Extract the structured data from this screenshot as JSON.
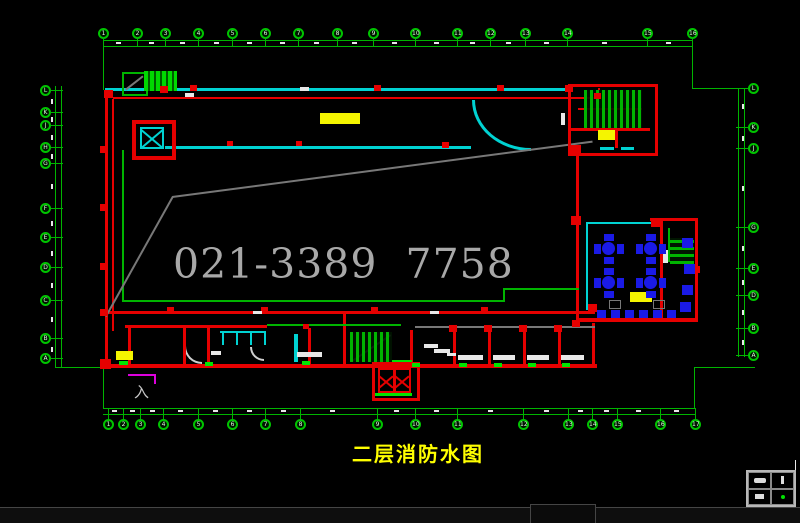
{
  "title_label": {
    "text": "二层消防水图"
  },
  "watermark": {
    "text": "021-3389 7758"
  },
  "entrance_mark": {
    "text": "入"
  },
  "palette": {
    "green": "#00b400",
    "bgreen": "#00e400",
    "cyan": "#00d2d2",
    "red": "#e60000",
    "yellow": "#f5f500",
    "blue": "#1a1ae6",
    "magenta": "#dd00dd",
    "gray": "#787878",
    "white": "#e8e8e8"
  },
  "grid_bubbles": {
    "top": {
      "cy": 33,
      "x": [
        103,
        137,
        165,
        198,
        232,
        265,
        298,
        337,
        373,
        415,
        457,
        490,
        525,
        567,
        647,
        692
      ],
      "labels": [
        "1",
        "2",
        "3",
        "4",
        "5",
        "6",
        "7",
        "8",
        "9",
        "10",
        "11",
        "12",
        "13",
        "14",
        "15",
        "16"
      ]
    },
    "bottom": {
      "cy": 424,
      "x": [
        108,
        123,
        140,
        163,
        198,
        232,
        265,
        300,
        377,
        415,
        457,
        523,
        568,
        592,
        617,
        660,
        695
      ],
      "labels": [
        "1",
        "2",
        "3",
        "4",
        "5",
        "6",
        "7",
        "8",
        "9",
        "10",
        "11",
        "12",
        "13",
        "14",
        "15",
        "16",
        "17"
      ]
    },
    "left": {
      "cx": 45,
      "y": [
        90,
        112,
        125,
        147,
        163,
        208,
        237,
        267,
        300,
        338,
        358
      ],
      "labels": [
        "L",
        "K",
        "J",
        "H",
        "G",
        "F",
        "E",
        "D",
        "C",
        "B",
        "A"
      ]
    },
    "right": {
      "cx": 753,
      "y": [
        88,
        127,
        148,
        227,
        268,
        295,
        328,
        355
      ],
      "labels": [
        "L",
        "K",
        "J",
        "G",
        "E",
        "D",
        "B",
        "A"
      ]
    }
  },
  "drawing": {
    "lines": [
      {
        "n": "dim-top-1",
        "x": 103,
        "y": 40,
        "w": 590,
        "h": 1,
        "c": "green"
      },
      {
        "n": "dim-top-2",
        "x": 103,
        "y": 46,
        "w": 590,
        "h": 1,
        "c": "green"
      },
      {
        "n": "dim-left-1",
        "x": 55,
        "y": 86,
        "w": 1,
        "h": 281,
        "c": "green"
      },
      {
        "n": "dim-left-2",
        "x": 61,
        "y": 86,
        "w": 1,
        "h": 281,
        "c": "green"
      },
      {
        "n": "dim-right-1",
        "x": 738,
        "y": 88,
        "w": 1,
        "h": 269,
        "c": "green"
      },
      {
        "n": "dim-right-2",
        "x": 744,
        "y": 88,
        "w": 1,
        "h": 269,
        "c": "green"
      },
      {
        "n": "dim-bottom-1",
        "x": 103,
        "y": 408,
        "w": 592,
        "h": 1,
        "c": "green"
      },
      {
        "n": "dim-bottom-2",
        "x": 103,
        "y": 414,
        "w": 592,
        "h": 1,
        "c": "green"
      },
      {
        "n": "dim-conn-tl",
        "x": 103,
        "y": 46,
        "w": 1,
        "h": 44,
        "c": "green"
      },
      {
        "n": "dim-conn-tr-v",
        "x": 692,
        "y": 46,
        "w": 1,
        "h": 43,
        "c": "green"
      },
      {
        "n": "dim-conn-tr-h",
        "x": 692,
        "y": 88,
        "w": 48,
        "h": 1,
        "c": "green"
      },
      {
        "n": "dim-conn-bl-h",
        "x": 55,
        "y": 367,
        "w": 49,
        "h": 1,
        "c": "green"
      },
      {
        "n": "dim-conn-bl-v",
        "x": 103,
        "y": 367,
        "w": 1,
        "h": 41,
        "c": "green"
      },
      {
        "n": "dim-conn-br-v",
        "x": 694,
        "y": 368,
        "w": 1,
        "h": 40,
        "c": "green"
      },
      {
        "n": "dim-conn-br-h",
        "x": 694,
        "y": 367,
        "w": 61,
        "h": 1,
        "c": "green"
      },
      {
        "n": "wall-top",
        "x": 105,
        "y": 88,
        "w": 464,
        "h": 3,
        "c": "cyan"
      },
      {
        "n": "wall-top-window",
        "x": 629,
        "y": 84,
        "w": 21,
        "h": 3,
        "c": "cyan"
      },
      {
        "n": "wall-corridor",
        "x": 165,
        "y": 146,
        "w": 306,
        "h": 3,
        "c": "cyan"
      },
      {
        "n": "dining-wall-top",
        "x": 588,
        "y": 222,
        "w": 68,
        "h": 2,
        "c": "cyan"
      },
      {
        "n": "dining-wall-left",
        "x": 586,
        "y": 222,
        "w": 2,
        "h": 88,
        "c": "cyan"
      },
      {
        "n": "stair-window-1",
        "x": 600,
        "y": 147,
        "w": 14,
        "h": 3,
        "c": "cyan"
      },
      {
        "n": "stair-window-2",
        "x": 621,
        "y": 147,
        "w": 13,
        "h": 3,
        "c": "cyan"
      },
      {
        "n": "toilet-wall-top",
        "x": 220,
        "y": 331,
        "w": 46,
        "h": 2,
        "c": "cyan"
      },
      {
        "n": "toilet-stall-1",
        "x": 222,
        "y": 331,
        "w": 2,
        "h": 14,
        "c": "cyan"
      },
      {
        "n": "toilet-stall-2",
        "x": 236,
        "y": 331,
        "w": 2,
        "h": 14,
        "c": "cyan"
      },
      {
        "n": "toilet-stall-3",
        "x": 250,
        "y": 331,
        "w": 2,
        "h": 14,
        "c": "cyan"
      },
      {
        "n": "toilet-stall-4",
        "x": 264,
        "y": 331,
        "w": 2,
        "h": 14,
        "c": "cyan"
      },
      {
        "n": "toilet-riser",
        "x": 294,
        "y": 334,
        "w": 4,
        "h": 28,
        "c": "cyan"
      },
      {
        "n": "wall-left-outer",
        "x": 105,
        "y": 97,
        "w": 3,
        "h": 270,
        "c": "red"
      },
      {
        "n": "wall-left-inner",
        "x": 112,
        "y": 99,
        "w": 2,
        "h": 232,
        "c": "red"
      },
      {
        "n": "pipe-top",
        "x": 113,
        "y": 97,
        "w": 487,
        "h": 2,
        "c": "red"
      },
      {
        "n": "pipe-stair-drop",
        "x": 598,
        "y": 88,
        "w": 2,
        "h": 10,
        "c": "red"
      },
      {
        "n": "pipe-main",
        "x": 105,
        "y": 311,
        "w": 490,
        "h": 3,
        "c": "red"
      },
      {
        "n": "wall-lowerwing-top",
        "x": 125,
        "y": 325,
        "w": 142,
        "h": 3,
        "c": "red"
      },
      {
        "n": "wall-bottom",
        "x": 105,
        "y": 364,
        "w": 492,
        "h": 4,
        "c": "red"
      },
      {
        "n": "room-div-1",
        "x": 128,
        "y": 328,
        "w": 3,
        "h": 38,
        "c": "red"
      },
      {
        "n": "room-div-2",
        "x": 183,
        "y": 328,
        "w": 3,
        "h": 38,
        "c": "red"
      },
      {
        "n": "room-div-3",
        "x": 207,
        "y": 328,
        "w": 3,
        "h": 38,
        "c": "red"
      },
      {
        "n": "room-div-4",
        "x": 308,
        "y": 328,
        "w": 3,
        "h": 38,
        "c": "red"
      },
      {
        "n": "room-div-5",
        "x": 343,
        "y": 313,
        "w": 3,
        "h": 53,
        "c": "red"
      },
      {
        "n": "room-div-6",
        "x": 410,
        "y": 330,
        "w": 3,
        "h": 36,
        "c": "red"
      },
      {
        "n": "room-div-7",
        "x": 453,
        "y": 330,
        "w": 3,
        "h": 36,
        "c": "red"
      },
      {
        "n": "room-div-8",
        "x": 488,
        "y": 330,
        "w": 3,
        "h": 36,
        "c": "red"
      },
      {
        "n": "room-div-9",
        "x": 523,
        "y": 330,
        "w": 3,
        "h": 36,
        "c": "red"
      },
      {
        "n": "room-div-10",
        "x": 558,
        "y": 330,
        "w": 3,
        "h": 36,
        "c": "red"
      },
      {
        "n": "room-div-11",
        "x": 592,
        "y": 323,
        "w": 3,
        "h": 43,
        "c": "red"
      },
      {
        "n": "pipe-riser-vert",
        "x": 576,
        "y": 148,
        "w": 3,
        "h": 175,
        "c": "red"
      },
      {
        "n": "dining-wall-top-red",
        "x": 650,
        "y": 218,
        "w": 48,
        "h": 3,
        "c": "red"
      },
      {
        "n": "dining-wall-right-inner",
        "x": 660,
        "y": 221,
        "w": 3,
        "h": 99,
        "c": "red"
      },
      {
        "n": "dining-wall-right-outer",
        "x": 695,
        "y": 220,
        "w": 3,
        "h": 100,
        "c": "red"
      },
      {
        "n": "dining-wall-bottom",
        "x": 576,
        "y": 318,
        "w": 122,
        "h": 4,
        "c": "red"
      },
      {
        "n": "stair-handrail",
        "x": 578,
        "y": 108,
        "w": 64,
        "h": 2,
        "c": "red"
      },
      {
        "n": "stair-div-h",
        "x": 571,
        "y": 128,
        "w": 79,
        "h": 3,
        "c": "red"
      },
      {
        "n": "stair-div-v",
        "x": 615,
        "y": 131,
        "w": 3,
        "h": 17,
        "c": "red"
      },
      {
        "n": "inner-wall-v",
        "x": 122,
        "y": 150,
        "w": 2,
        "h": 152,
        "c": "green"
      },
      {
        "n": "inner-wall-h",
        "x": 122,
        "y": 300,
        "w": 383,
        "h": 2,
        "c": "green"
      },
      {
        "n": "pipe-green-riser-v",
        "x": 503,
        "y": 289,
        "w": 2,
        "h": 12,
        "c": "green"
      },
      {
        "n": "pipe-green-riser-h",
        "x": 503,
        "y": 288,
        "w": 76,
        "h": 2,
        "c": "green"
      },
      {
        "n": "pipe-green-low",
        "x": 267,
        "y": 324,
        "w": 134,
        "h": 2,
        "c": "green"
      },
      {
        "n": "ladder-stem",
        "x": 668,
        "y": 228,
        "w": 2,
        "h": 34,
        "c": "green"
      },
      {
        "n": "hall-gray-line",
        "x": 415,
        "y": 326,
        "w": 180,
        "h": 2,
        "c": "gray"
      },
      {
        "n": "magenta-line-h",
        "x": 128,
        "y": 374,
        "w": 28,
        "h": 2,
        "c": "magenta"
      },
      {
        "n": "magenta-line-v",
        "x": 154,
        "y": 374,
        "w": 2,
        "h": 10,
        "c": "magenta"
      },
      {
        "n": "titleblock-edge",
        "x": 795,
        "y": 460,
        "w": 1,
        "h": 47,
        "c": "white"
      },
      {
        "n": "shaftb-strip-top",
        "x": 374,
        "y": 360,
        "w": 38,
        "h": 3,
        "c": "bgreen"
      },
      {
        "n": "shaftb-strip-bottom",
        "x": 374,
        "y": 393,
        "w": 38,
        "h": 3,
        "c": "bgreen"
      }
    ],
    "rot_lines": [
      {
        "n": "watermark-edge-upper",
        "x": 172,
        "y": 196,
        "len": 424,
        "deg": -7.5,
        "c": "gray"
      },
      {
        "n": "watermark-edge-left",
        "x": 105,
        "y": 316,
        "len": 137,
        "deg": -60.8,
        "c": "gray"
      },
      {
        "n": "escalator-mark",
        "x": 125,
        "y": 89,
        "len": 22,
        "deg": -38,
        "c": "gray"
      },
      {
        "n": "stair2-diagonal",
        "x": 352,
        "y": 360,
        "len": 46,
        "deg": -34,
        "c": "gray"
      }
    ],
    "rects": [
      {
        "n": "stairwell-box",
        "x": 568,
        "y": 84,
        "w": 84,
        "h": 66,
        "b": 3,
        "c": "red"
      },
      {
        "n": "shaft-a-outer",
        "x": 132,
        "y": 120,
        "w": 36,
        "h": 32,
        "b": 4,
        "c": "red"
      },
      {
        "n": "shaft-a-xbox",
        "x": 140,
        "y": 127,
        "w": 20,
        "h": 18,
        "b": 2,
        "c": "cyan",
        "cls": "xbox"
      },
      {
        "n": "shaft-b-outer",
        "x": 372,
        "y": 362,
        "w": 42,
        "h": 33,
        "b": 3,
        "c": "red"
      },
      {
        "n": "shaft-b-x1",
        "x": 378,
        "y": 368,
        "w": 13,
        "h": 21,
        "b": 2,
        "c": "red",
        "cls": "xbox"
      },
      {
        "n": "shaft-b-x2",
        "x": 394,
        "y": 368,
        "w": 13,
        "h": 21,
        "b": 2,
        "c": "red",
        "cls": "xbox"
      },
      {
        "n": "escalator-box",
        "x": 122,
        "y": 72,
        "w": 22,
        "h": 20,
        "b": 2,
        "c": "green"
      },
      {
        "n": "chair-outline-1",
        "x": 609,
        "y": 300,
        "w": 10,
        "h": 7,
        "b": 1,
        "c": "gray"
      },
      {
        "n": "chair-outline-2",
        "x": 653,
        "y": 300,
        "w": 10,
        "h": 7,
        "b": 1,
        "c": "gray"
      }
    ],
    "striped": [
      {
        "n": "stair-treads",
        "x": 584,
        "y": 90,
        "w": 58,
        "h": 38,
        "dir": "v"
      },
      {
        "n": "escalator-belt",
        "x": 144,
        "y": 71,
        "w": 33,
        "h": 20,
        "dir": "v2"
      },
      {
        "n": "stair2-treads",
        "x": 350,
        "y": 332,
        "w": 42,
        "h": 30,
        "dir": "v"
      },
      {
        "n": "dining-ladder",
        "x": 670,
        "y": 238,
        "w": 24,
        "h": 26,
        "dir": "h"
      }
    ],
    "yellow_highlights": [
      [
        320,
        113,
        40,
        11
      ],
      [
        598,
        130,
        17,
        10
      ],
      [
        630,
        292,
        22,
        10
      ],
      [
        116,
        351,
        17,
        9
      ]
    ],
    "hydrants": [
      [
        190,
        85,
        7
      ],
      [
        374,
        85,
        7
      ],
      [
        497,
        85,
        7
      ],
      [
        565,
        85,
        8
      ],
      [
        227,
        141,
        6
      ],
      [
        296,
        141,
        6
      ],
      [
        442,
        142,
        7
      ],
      [
        100,
        146,
        8
      ],
      [
        100,
        204,
        8
      ],
      [
        100,
        263,
        8
      ],
      [
        100,
        309,
        8
      ],
      [
        104,
        90,
        9
      ],
      [
        160,
        86,
        8
      ],
      [
        167,
        307,
        7
      ],
      [
        261,
        307,
        7
      ],
      [
        371,
        307,
        7
      ],
      [
        481,
        307,
        7
      ],
      [
        588,
        304,
        9
      ],
      [
        449,
        325,
        8
      ],
      [
        484,
        325,
        8
      ],
      [
        519,
        325,
        8
      ],
      [
        554,
        325,
        8
      ],
      [
        571,
        145,
        10
      ],
      [
        571,
        216,
        10
      ],
      [
        572,
        320,
        8
      ],
      [
        651,
        219,
        9
      ],
      [
        692,
        266,
        8
      ],
      [
        100,
        359,
        11
      ],
      [
        594,
        93,
        7
      ],
      [
        303,
        324,
        6
      ]
    ],
    "white_marks": [
      [
        185,
        93,
        9,
        4
      ],
      [
        300,
        87,
        9,
        4
      ],
      [
        561,
        113,
        4,
        12
      ],
      [
        663,
        250,
        5,
        13
      ],
      [
        424,
        344,
        14,
        4
      ],
      [
        434,
        349,
        16,
        4
      ],
      [
        447,
        353,
        9,
        3
      ],
      [
        458,
        355,
        25,
        5
      ],
      [
        493,
        355,
        22,
        5
      ],
      [
        527,
        355,
        22,
        5
      ],
      [
        561,
        355,
        23,
        5
      ],
      [
        297,
        352,
        25,
        5
      ],
      [
        211,
        351,
        10,
        4
      ],
      [
        253,
        311,
        9,
        3
      ],
      [
        430,
        311,
        9,
        3
      ]
    ],
    "green_marks": [
      [
        119,
        361,
        9,
        4
      ],
      [
        205,
        362,
        8,
        4
      ],
      [
        302,
        361,
        8,
        4
      ],
      [
        412,
        363,
        8,
        4
      ],
      [
        459,
        363,
        8,
        4
      ],
      [
        494,
        363,
        8,
        4
      ],
      [
        528,
        363,
        8,
        4
      ],
      [
        562,
        363,
        8,
        4
      ]
    ],
    "dim_marks": {
      "top": {
        "y": 42,
        "x": [
          116,
          149,
          180,
          214,
          247,
          280,
          314,
          352,
          392,
          434,
          470,
          506,
          544,
          602,
          666
        ]
      },
      "bottom": {
        "y": 410,
        "x": [
          112,
          130,
          150,
          178,
          213,
          247,
          281,
          330,
          394,
          434,
          488,
          544,
          578,
          604,
          636,
          674
        ]
      },
      "left": {
        "x": 51,
        "y": [
          99,
          117,
          135,
          154,
          184,
          221,
          251,
          283,
          317,
          347
        ]
      },
      "right": {
        "x": 742,
        "y": [
          104,
          136,
          186,
          246,
          280,
          310,
          340
        ]
      }
    },
    "tables": [
      [
        609,
        249
      ],
      [
        651,
        249
      ],
      [
        609,
        283
      ],
      [
        651,
        283
      ]
    ],
    "chairs": [
      [
        597,
        310,
        9,
        8
      ],
      [
        611,
        310,
        9,
        8
      ],
      [
        625,
        310,
        9,
        8
      ],
      [
        639,
        310,
        9,
        8
      ],
      [
        653,
        310,
        9,
        8
      ],
      [
        667,
        310,
        9,
        8
      ],
      [
        682,
        238,
        11,
        10
      ],
      [
        684,
        264,
        11,
        10
      ],
      [
        682,
        285,
        11,
        10
      ],
      [
        680,
        302,
        11,
        10
      ]
    ]
  },
  "legend_panel": {
    "cells": [
      "sofa-symbol",
      "person-symbol",
      "dash-symbol",
      "green-dot-symbol"
    ]
  }
}
